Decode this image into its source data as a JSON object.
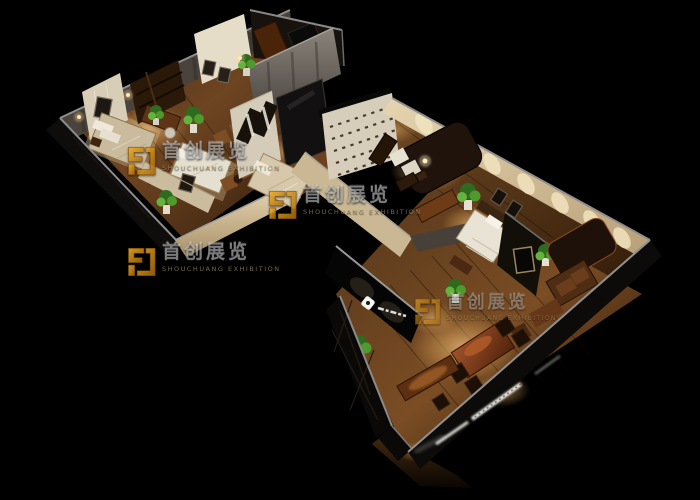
{
  "watermark": {
    "cn": "首创展览",
    "en": "SHOUCHUANG EXHIBITION"
  },
  "colors": {
    "background": "#000000",
    "watermark_logo_gold": "#e09a14",
    "watermark_text": "rgba(240,240,240,0.48)",
    "wall_beige": "#d8c8a8",
    "floor_wood": "#6b4423"
  }
}
